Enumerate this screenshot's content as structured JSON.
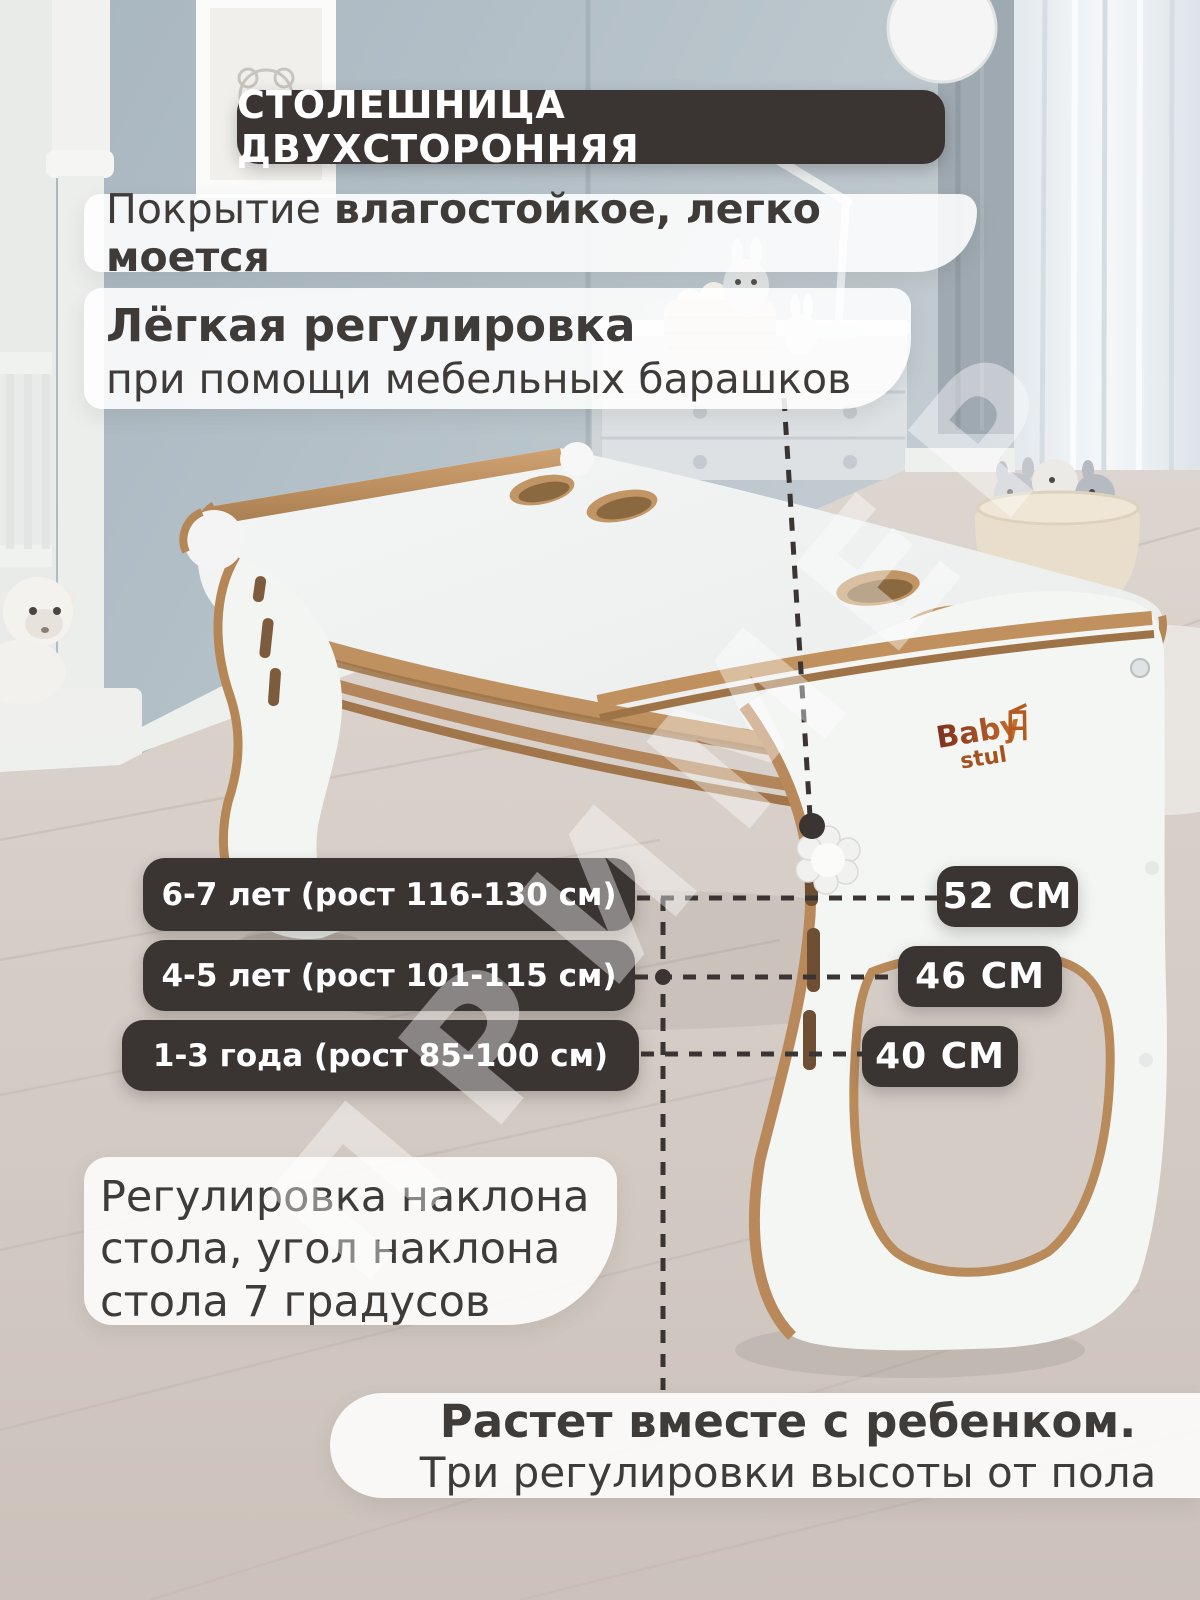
{
  "watermark": {
    "text": "ПРИМЕР"
  },
  "top_badge": {
    "label": "СТОЛЕШНИЦА ДВУХСТОРОННЯЯ"
  },
  "features": {
    "coating_normal": "Покрытие ",
    "coating_bold": "влагостойкое, легко моется",
    "adjust_bold": "Лёгкая регулировка",
    "adjust_rest": "при помощи мебельных барашков"
  },
  "age_rows": [
    {
      "age": "6-7 лет (рост 116-130 см)",
      "height": "52 СМ"
    },
    {
      "age": "4-5 лет (рост 101-115 см)",
      "height": "46 СМ"
    },
    {
      "age": "1-3 года (рост 85-100 см)",
      "height": "40 СМ"
    }
  ],
  "tilt_box": {
    "line1": "Регулировка наклона",
    "line2": "стола, угол наклона",
    "line3": "стола 7 градусов"
  },
  "grow_box": {
    "bold": "Растет вместе с ребенком.",
    "rest": "Три регулировки высоты от пола"
  },
  "brand": {
    "word1": "Baby",
    "word2": "stul"
  },
  "colors": {
    "dark_badge": "#3a3533",
    "text": "#3e3b39",
    "wood": "#c0915f",
    "wood_dark": "#9d7347",
    "wall": "#b2bec6",
    "floor": "#d6cdc7",
    "white_box": "rgba(255,255,255,0.87)"
  }
}
